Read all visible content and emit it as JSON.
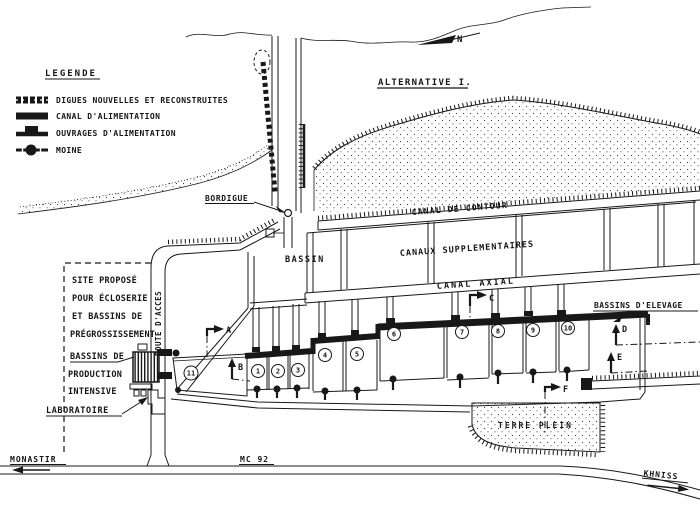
{
  "legend": {
    "title": "LEGENDE",
    "items": [
      {
        "symbol": "segmented-dike-bar",
        "label": "DIGUES NOUVELLES ET RECONSTRUITES"
      },
      {
        "symbol": "solid-black-bar",
        "label": "CANAL D'ALIMENTATION"
      },
      {
        "symbol": "bar-with-bump",
        "label": "OUVRAGES D'ALIMENTATION"
      },
      {
        "symbol": "line-with-filled-circle",
        "label": "MOINE"
      }
    ]
  },
  "compass": {
    "label": "N"
  },
  "plan": {
    "title": "ALTERNATIVE I.",
    "labels": {
      "bordigue": "BORDIGUE",
      "bassin": "BASSIN",
      "canal_contour": "CANAL DE CONTOUR",
      "canaux_supplementaires": "CANAUX SUPPLEMENTAIRES",
      "canal_axial": "CANAL AXIAL",
      "bassins_elevage": "BASSINS D'ELEVAGE",
      "terre_plein": "TERRE PLEIN",
      "route_acces": "ROUTE D'ACCES",
      "laboratoire": "LABORATOIRE"
    },
    "site_note_lines": [
      "SITE PROPOSÉ",
      "POUR ÉCLOSERIE",
      "ET BASSINS DE",
      "PRÉGROSSISSEMENT"
    ],
    "production_note_lines": [
      "BASSINS DE",
      "PRODUCTION",
      "INTENSIVE"
    ],
    "basin_numbers": [
      "1",
      "2",
      "3",
      "4",
      "5",
      "6",
      "7",
      "8",
      "9",
      "10",
      "11"
    ],
    "section_marks": [
      "A",
      "B",
      "C",
      "D",
      "E",
      "F"
    ],
    "roads": {
      "left": "MONASTIR",
      "name": "MC 92",
      "right": "KHNISS"
    }
  },
  "colors": {
    "ink": "#181818",
    "paper": "#ffffff"
  }
}
